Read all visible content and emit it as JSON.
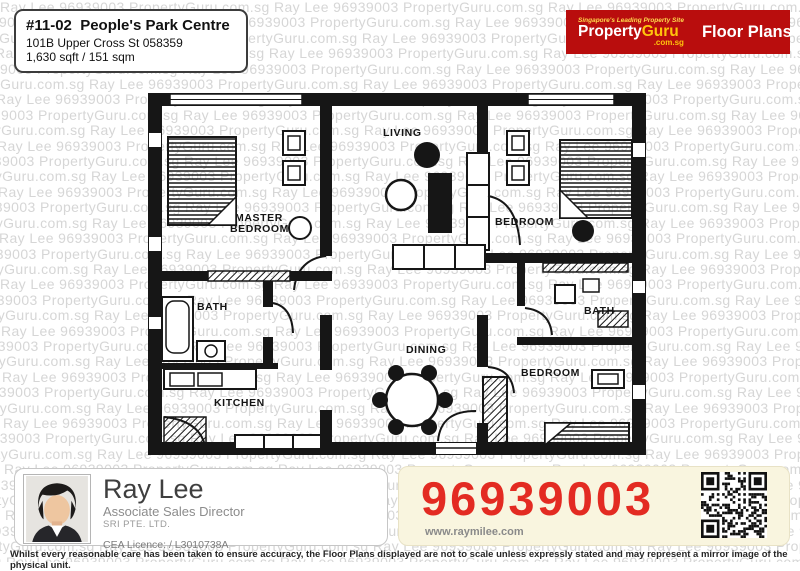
{
  "watermark": {
    "text": "Ray Lee 96939003 PropertyGuru.com.sg",
    "color": "#d6d6d6"
  },
  "listing": {
    "title": "#11-02  People's Park Centre",
    "address": "101B Upper Cross St 058359",
    "area": "1,630 sqft / 151 sqm"
  },
  "brand": {
    "tagline": "Singapore's Leading Property Site",
    "name_left": "Property",
    "name_right": "Guru",
    "domain": ".com.sg",
    "product": "Floor Plans",
    "bg_color": "#b90d0d",
    "accent_color": "#ffc40c"
  },
  "floorplan": {
    "labels": {
      "master_line1": "MASTER",
      "master_line2": "BEDROOM",
      "living": "LIVING",
      "bedroom_right": "BEDROOM",
      "bath_left": "BATH",
      "kitchen": "KITCHEN",
      "dining": "DINING",
      "bath_right": "BATH",
      "bedroom_bottom": "BEDROOM"
    }
  },
  "agent": {
    "name": "Ray Lee",
    "title": "Associate Sales Director",
    "company": "SRI PTE. LTD.",
    "cea": "CEA Licence:  / L3010738A",
    "phone": "96939003",
    "website": "www.raymilee.com",
    "phone_color": "#e32b22"
  },
  "disclaimer": "Whilst every reasonable care has been taken to ensure accuracy, the Floor Plans displayed are not to scale unless expressly stated and may represent a mirror image of the physical unit."
}
